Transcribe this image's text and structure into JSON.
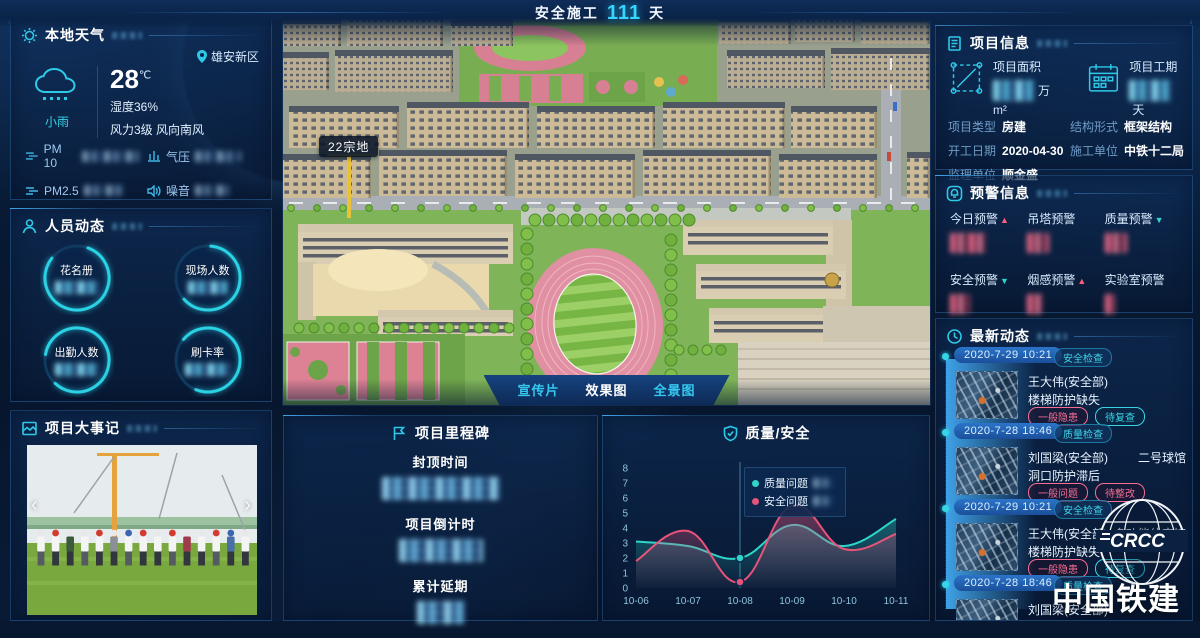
{
  "banner": {
    "prefix": "安全施工",
    "days": "111",
    "unit": "天"
  },
  "weather": {
    "title": "本地天气",
    "location": "雄安新区",
    "condition": "小雨",
    "temp": "28",
    "temp_unit": "℃",
    "humidity": "湿度36%",
    "wind": "风力3级 风向南风",
    "metrics": [
      {
        "label": "PM 10"
      },
      {
        "label": "气压"
      },
      {
        "label": "PM2.5"
      },
      {
        "label": "噪音"
      }
    ]
  },
  "personnel": {
    "title": "人员动态",
    "items": [
      {
        "label": "花名册"
      },
      {
        "label": "现场人数"
      },
      {
        "label": "出勤人数"
      },
      {
        "label": "刷卡率"
      }
    ]
  },
  "events": {
    "title": "项目大事记"
  },
  "main_view": {
    "plot_label": "22宗地",
    "tabs": [
      {
        "label": "宣传片"
      },
      {
        "label": "效果图"
      },
      {
        "label": "全景图"
      }
    ],
    "selected_tab": "效果图"
  },
  "project_info": {
    "title": "项目信息",
    "stats": [
      {
        "label": "项目面积",
        "unit": "万m²"
      },
      {
        "label": "项目工期",
        "unit": "天"
      }
    ],
    "fields": [
      {
        "label": "项目类型",
        "value": "房建"
      },
      {
        "label": "结构形式",
        "value": "框架结构"
      },
      {
        "label": "开工日期",
        "value": "2020-04-30"
      },
      {
        "label": "施工单位",
        "value": "中铁十二局"
      },
      {
        "label": "监理单位",
        "value": "顺金盛"
      }
    ]
  },
  "alerts": {
    "title": "预警信息",
    "items": [
      {
        "label": "今日预警",
        "trend": "up"
      },
      {
        "label": "吊塔预警",
        "trend": ""
      },
      {
        "label": "质量预警",
        "trend": "down"
      },
      {
        "label": "安全预警",
        "trend": "down"
      },
      {
        "label": "烟感预警",
        "trend": "up"
      },
      {
        "label": "实验室预警",
        "trend": ""
      }
    ]
  },
  "updates": {
    "title": "最新动态",
    "items": [
      {
        "date": "2020-7-29 10:21",
        "category": "安全检查",
        "person": "王大伟(安全部)",
        "location": "",
        "issue": "楼梯防护缺失",
        "tag1": "一般隐患",
        "tag2": "待复查"
      },
      {
        "date": "2020-7-28 18:46",
        "category": "质量检查",
        "person": "刘国梁(安全部)",
        "location": "二号球馆",
        "issue": "洞口防护滞后",
        "tag1": "一般问题",
        "tag2": "待整改"
      },
      {
        "date": "2020-7-29 10:21",
        "category": "安全检查",
        "person": "王大伟(安全部)",
        "location": "多功能体育馆",
        "issue": "楼梯防护缺失",
        "tag1": "一般隐患",
        "tag2": "待复查"
      },
      {
        "date": "2020-7-28 18:46",
        "category": "质量检查",
        "person": "刘国梁(安全部)",
        "location": "",
        "issue": "",
        "tag1": "",
        "tag2": ""
      }
    ]
  },
  "milestones": {
    "title": "项目里程碑",
    "items": [
      {
        "label": "封顶时间"
      },
      {
        "label": "项目倒计时"
      },
      {
        "label": "累计延期"
      }
    ]
  },
  "chart_data": {
    "type": "line",
    "title": "质量/安全",
    "x": [
      "10-06",
      "10-07",
      "10-08",
      "10-09",
      "10-10",
      "10-11"
    ],
    "series": [
      {
        "name": "质量问题",
        "color": "#2fd5c8",
        "values": [
          3.1,
          2.8,
          2.0,
          4.2,
          2.8,
          4.6
        ]
      },
      {
        "name": "安全问题",
        "color": "#e8537a",
        "values": [
          1.8,
          3.8,
          0.4,
          5.5,
          2.6,
          3.6
        ]
      }
    ],
    "ylim": [
      0,
      8
    ],
    "yticks": [
      0,
      1,
      2,
      3,
      4,
      5,
      6,
      7,
      8
    ],
    "grid": false,
    "highlight_x": "10-08",
    "legend_position": "tooltip"
  },
  "logo": {
    "abbr": "CRCC",
    "name": "中国铁建"
  }
}
